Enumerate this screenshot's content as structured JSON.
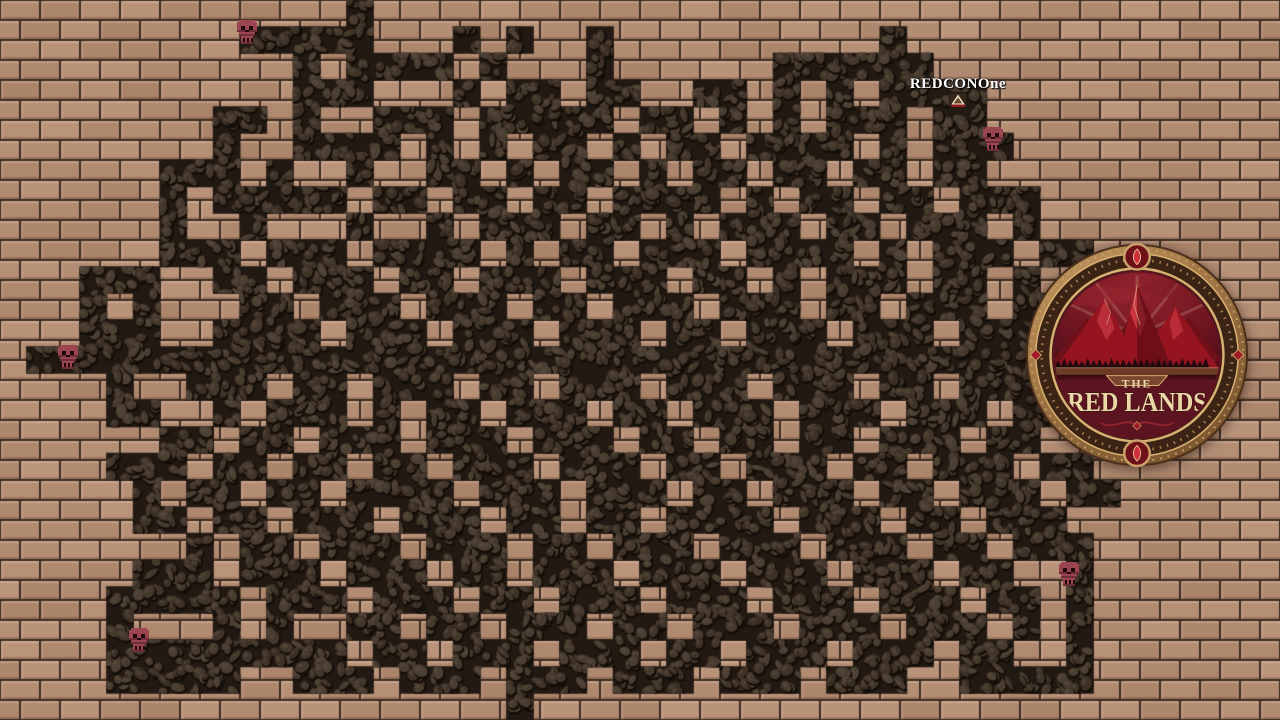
{
  "game": {
    "map_name": "brick-maze-dungeon",
    "player": {
      "name": "REDCONOne",
      "x": 958,
      "y": 100
    },
    "skulls": [
      {
        "x": 247,
        "y": 33
      },
      {
        "x": 68,
        "y": 358
      },
      {
        "x": 993,
        "y": 140
      },
      {
        "x": 139,
        "y": 641
      },
      {
        "x": 1069,
        "y": 575
      }
    ],
    "logo": {
      "title_top": "THE",
      "title_main": "RED LANDS",
      "x": 1137,
      "y": 355,
      "radius": 113
    }
  },
  "maze": {
    "cols": 48,
    "rows": 27,
    "cell_size": 26.6667,
    "segments": [
      [
        [
          13,
          13
        ]
      ],
      [
        [
          9,
          13
        ],
        [
          17,
          17
        ],
        [
          19,
          19
        ],
        [
          22,
          22
        ],
        [
          33,
          33
        ]
      ],
      [
        [
          11,
          11
        ],
        [
          13,
          16
        ],
        [
          18,
          18
        ],
        [
          22,
          22
        ],
        [
          29,
          34
        ]
      ],
      [
        [
          11,
          13
        ],
        [
          17,
          17
        ],
        [
          19,
          20
        ],
        [
          22,
          23
        ],
        [
          26,
          27
        ],
        [
          29,
          29
        ],
        [
          31,
          31
        ],
        [
          33,
          36
        ]
      ],
      [
        [
          8,
          9
        ],
        [
          11,
          11
        ],
        [
          14,
          16
        ],
        [
          18,
          22
        ],
        [
          24,
          25
        ],
        [
          27,
          27
        ],
        [
          29,
          29
        ],
        [
          31,
          33
        ],
        [
          35,
          36
        ]
      ],
      [
        [
          8,
          8
        ],
        [
          11,
          14
        ],
        [
          16,
          16
        ],
        [
          18,
          18
        ],
        [
          20,
          21
        ],
        [
          23,
          23
        ],
        [
          25,
          26
        ],
        [
          28,
          31
        ],
        [
          33,
          33
        ],
        [
          35,
          37
        ]
      ],
      [
        [
          6,
          8
        ],
        [
          10,
          10
        ],
        [
          13,
          13
        ],
        [
          16,
          17
        ],
        [
          19,
          19
        ],
        [
          21,
          22
        ],
        [
          24,
          24
        ],
        [
          26,
          27
        ],
        [
          29,
          30
        ],
        [
          32,
          33
        ],
        [
          35,
          36
        ]
      ],
      [
        [
          6,
          6
        ],
        [
          8,
          12
        ],
        [
          14,
          15
        ],
        [
          17,
          18
        ],
        [
          20,
          21
        ],
        [
          23,
          26
        ],
        [
          28,
          28
        ],
        [
          30,
          31
        ],
        [
          33,
          34
        ],
        [
          36,
          38
        ]
      ],
      [
        [
          6,
          6
        ],
        [
          9,
          9
        ],
        [
          13,
          13
        ],
        [
          16,
          16
        ],
        [
          18,
          20
        ],
        [
          22,
          23
        ],
        [
          25,
          25
        ],
        [
          27,
          29
        ],
        [
          31,
          32
        ],
        [
          34,
          36
        ],
        [
          38,
          38
        ]
      ],
      [
        [
          6,
          8
        ],
        [
          10,
          12
        ],
        [
          14,
          17
        ],
        [
          19,
          19
        ],
        [
          21,
          22
        ],
        [
          24,
          26
        ],
        [
          28,
          31
        ],
        [
          33,
          33
        ],
        [
          35,
          37
        ],
        [
          39,
          40
        ]
      ],
      [
        [
          3,
          5
        ],
        [
          8,
          9
        ],
        [
          11,
          13
        ],
        [
          15,
          16
        ],
        [
          18,
          20
        ],
        [
          22,
          24
        ],
        [
          26,
          27
        ],
        [
          29,
          29
        ],
        [
          31,
          33
        ],
        [
          35,
          36
        ],
        [
          38,
          38
        ]
      ],
      [
        [
          3,
          3
        ],
        [
          5,
          5
        ],
        [
          9,
          10
        ],
        [
          12,
          14
        ],
        [
          16,
          18
        ],
        [
          20,
          21
        ],
        [
          23,
          25
        ],
        [
          27,
          29
        ],
        [
          31,
          32
        ],
        [
          34,
          36
        ],
        [
          38,
          39
        ]
      ],
      [
        [
          3,
          5
        ],
        [
          8,
          11
        ],
        [
          13,
          15
        ],
        [
          17,
          19
        ],
        [
          21,
          23
        ],
        [
          25,
          26
        ],
        [
          28,
          30
        ],
        [
          32,
          34
        ],
        [
          36,
          38
        ]
      ],
      [
        [
          1,
          39
        ]
      ],
      [
        [
          4,
          4
        ],
        [
          7,
          9
        ],
        [
          11,
          12
        ],
        [
          14,
          16
        ],
        [
          18,
          19
        ],
        [
          21,
          23
        ],
        [
          25,
          27
        ],
        [
          29,
          31
        ],
        [
          33,
          34
        ],
        [
          36,
          38
        ]
      ],
      [
        [
          4,
          5
        ],
        [
          8,
          8
        ],
        [
          10,
          12
        ],
        [
          14,
          14
        ],
        [
          16,
          17
        ],
        [
          19,
          21
        ],
        [
          23,
          24
        ],
        [
          26,
          28
        ],
        [
          30,
          32
        ],
        [
          34,
          36
        ],
        [
          38,
          39
        ]
      ],
      [
        [
          6,
          7
        ],
        [
          9,
          10
        ],
        [
          12,
          14
        ],
        [
          16,
          18
        ],
        [
          20,
          22
        ],
        [
          24,
          25
        ],
        [
          27,
          28
        ],
        [
          30,
          31
        ],
        [
          33,
          35
        ],
        [
          37,
          38
        ]
      ],
      [
        [
          4,
          6
        ],
        [
          8,
          9
        ],
        [
          11,
          12
        ],
        [
          14,
          15
        ],
        [
          17,
          19
        ],
        [
          21,
          23
        ],
        [
          25,
          26
        ],
        [
          28,
          30
        ],
        [
          32,
          33
        ],
        [
          35,
          37
        ],
        [
          39,
          40
        ]
      ],
      [
        [
          5,
          5
        ],
        [
          7,
          8
        ],
        [
          10,
          11
        ],
        [
          13,
          16
        ],
        [
          18,
          20
        ],
        [
          22,
          24
        ],
        [
          26,
          27
        ],
        [
          29,
          31
        ],
        [
          33,
          34
        ],
        [
          36,
          38
        ],
        [
          40,
          41
        ]
      ],
      [
        [
          5,
          6
        ],
        [
          8,
          9
        ],
        [
          11,
          13
        ],
        [
          15,
          17
        ],
        [
          19,
          20
        ],
        [
          22,
          23
        ],
        [
          25,
          28
        ],
        [
          30,
          32
        ],
        [
          34,
          35
        ],
        [
          37,
          39
        ]
      ],
      [
        [
          7,
          7
        ],
        [
          9,
          10
        ],
        [
          12,
          14
        ],
        [
          16,
          18
        ],
        [
          20,
          21
        ],
        [
          23,
          25
        ],
        [
          27,
          29
        ],
        [
          31,
          33
        ],
        [
          35,
          36
        ],
        [
          38,
          40
        ]
      ],
      [
        [
          5,
          7
        ],
        [
          9,
          11
        ],
        [
          13,
          15
        ],
        [
          17,
          18
        ],
        [
          20,
          22
        ],
        [
          24,
          26
        ],
        [
          28,
          30
        ],
        [
          32,
          34
        ],
        [
          36,
          37
        ],
        [
          40,
          40
        ]
      ],
      [
        [
          4,
          8
        ],
        [
          10,
          12
        ],
        [
          14,
          16
        ],
        [
          18,
          19
        ],
        [
          21,
          23
        ],
        [
          25,
          27
        ],
        [
          29,
          31
        ],
        [
          33,
          35
        ],
        [
          37,
          38
        ],
        [
          40,
          40
        ]
      ],
      [
        [
          4,
          4
        ],
        [
          8,
          8
        ],
        [
          10,
          10
        ],
        [
          13,
          14
        ],
        [
          16,
          17
        ],
        [
          19,
          21
        ],
        [
          23,
          24
        ],
        [
          26,
          28
        ],
        [
          30,
          32
        ],
        [
          34,
          36
        ],
        [
          38,
          38
        ],
        [
          40,
          40
        ]
      ],
      [
        [
          4,
          12
        ],
        [
          14,
          15
        ],
        [
          17,
          19
        ],
        [
          21,
          23
        ],
        [
          25,
          26
        ],
        [
          28,
          30
        ],
        [
          32,
          34
        ],
        [
          36,
          37
        ],
        [
          40,
          40
        ]
      ],
      [
        [
          4,
          8
        ],
        [
          11,
          13
        ],
        [
          15,
          17
        ],
        [
          19,
          21
        ],
        [
          23,
          25
        ],
        [
          27,
          29
        ],
        [
          31,
          33
        ],
        [
          36,
          40
        ]
      ],
      [
        [
          19,
          19
        ]
      ]
    ]
  },
  "colors": {
    "brick_base": "#b18c73",
    "brick_light": "#c79e84",
    "brick_dark": "#8d6b55",
    "mortar": "#3c2c21",
    "path_base": "#211912",
    "stone": "#3b2f25",
    "stone_light": "#4d4034",
    "stone_rim": "#140e08",
    "skull": "#9a4550",
    "skull_dark": "#6e2e38",
    "skull_eye": "#200a0d",
    "logo_bronze": "#b98c5a",
    "logo_maroon": "#5c1420",
    "logo_red": "#a11a28",
    "logo_cream": "#ead8a6"
  }
}
